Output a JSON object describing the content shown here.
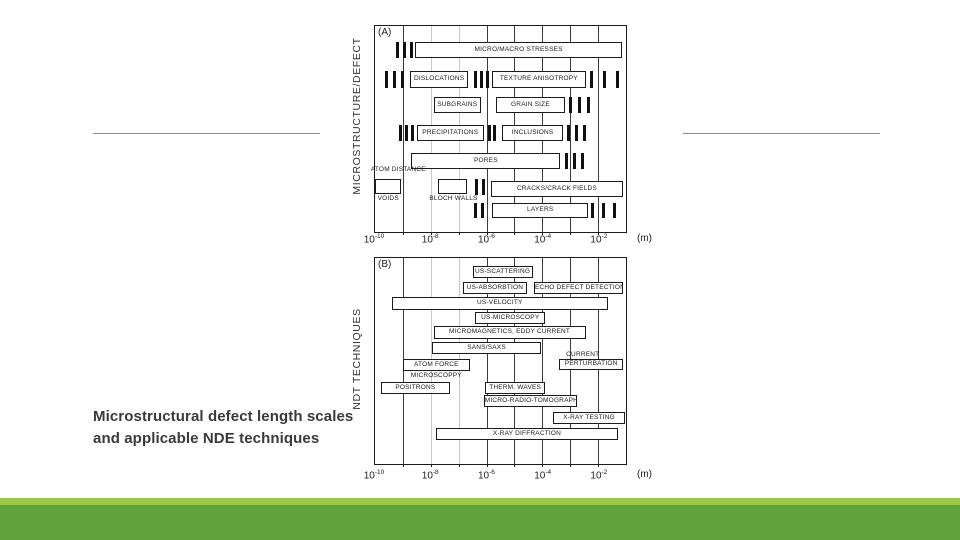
{
  "slide": {
    "caption_line1": "Microstructural defect length scales",
    "caption_line2": "and applicable NDE techniques",
    "caption_color": "#3a3a3a",
    "accent_light_green": "#9bc847",
    "accent_dark_green": "#61a33d",
    "divider_color": "#8a8a8a"
  },
  "chart_data": [
    {
      "type": "bar",
      "id": "A",
      "corner_label": "(A)",
      "axis_title": "MICROSTRUCTURE/DEFECT",
      "unit_label": "(m)",
      "x_scale": "log10 length in meters",
      "x_min": -10,
      "x_max": -1,
      "x_tick_exponents": [
        -10,
        -8,
        -6,
        -4,
        -2
      ],
      "gridline_exponents": [
        -9,
        -8,
        -7,
        -6,
        -5,
        -4,
        -3,
        -2
      ],
      "light_gridlines": [
        -8,
        -7
      ],
      "items": [
        {
          "type": "ticks",
          "from": -9.25,
          "to": -8.65,
          "top": 16,
          "h": 16
        },
        {
          "type": "box",
          "label": "MICRO/MACRO STRESSES",
          "from": -8.55,
          "to": -1.15,
          "top": 16,
          "h": 16
        },
        {
          "type": "ticks",
          "from": -9.65,
          "to": -8.95,
          "top": 45,
          "h": 17
        },
        {
          "type": "box",
          "label": "DISLOCATIONS",
          "from": -8.75,
          "to": -6.65,
          "top": 45,
          "h": 17
        },
        {
          "type": "ticks",
          "from": -6.45,
          "to": -5.9,
          "top": 45,
          "h": 17
        },
        {
          "type": "box",
          "label": "TEXTURE ANISOTROPY",
          "from": -5.8,
          "to": -2.45,
          "top": 45,
          "h": 17
        },
        {
          "type": "ticks",
          "from": -2.3,
          "to": -1.25,
          "top": 45,
          "h": 17
        },
        {
          "type": "box",
          "label": "SUBGRAINS",
          "from": -7.9,
          "to": -6.2,
          "top": 71,
          "h": 16
        },
        {
          "type": "box",
          "label": "GRAIN SIZE",
          "from": -5.65,
          "to": -3.2,
          "top": 71,
          "h": 16
        },
        {
          "type": "ticks",
          "from": -3.05,
          "to": -2.3,
          "top": 71,
          "h": 16
        },
        {
          "type": "ticks",
          "from": -9.15,
          "to": -8.6,
          "top": 99,
          "h": 16
        },
        {
          "type": "box",
          "label": "PRECIPITATIONS",
          "from": -8.5,
          "to": -6.1,
          "top": 99,
          "h": 16
        },
        {
          "type": "ticks",
          "from": -5.95,
          "to": -5.65,
          "top": 99,
          "h": 16,
          "n": 2
        },
        {
          "type": "box",
          "label": "INCLUSIONS",
          "from": -5.45,
          "to": -3.25,
          "top": 99,
          "h": 16
        },
        {
          "type": "ticks",
          "from": -3.1,
          "to": -2.45,
          "top": 99,
          "h": 16
        },
        {
          "type": "box",
          "label": "PORES",
          "from": -8.7,
          "to": -3.35,
          "top": 127,
          "h": 16
        },
        {
          "type": "ticks",
          "from": -3.2,
          "to": -2.5,
          "top": 127,
          "h": 16
        },
        {
          "type": "text",
          "label": "ATOM DISTANCE",
          "from": -10.15,
          "to": -7.0,
          "top": 140,
          "h": 11,
          "align": "left"
        },
        {
          "type": "box",
          "label": "",
          "from": -10,
          "to": -9.05,
          "top": 153,
          "h": 15
        },
        {
          "type": "text",
          "label": "VOIDS",
          "from": -10,
          "to": -9.05,
          "top": 169,
          "h": 10
        },
        {
          "type": "box",
          "label": "",
          "from": -7.75,
          "to": -6.7,
          "top": 153,
          "h": 15
        },
        {
          "type": "text",
          "label": "BLOCH WALLS",
          "from": -8.05,
          "to": -6.4,
          "top": 169,
          "h": 10
        },
        {
          "type": "ticks",
          "from": -6.4,
          "to": -6.05,
          "top": 153,
          "h": 16,
          "n": 2
        },
        {
          "type": "box",
          "label": "CRACKS/CRACK FIELDS",
          "from": -5.85,
          "to": -1.1,
          "top": 155,
          "h": 16
        },
        {
          "type": "ticks",
          "from": -6.45,
          "to": -6.1,
          "top": 177,
          "h": 15,
          "n": 2
        },
        {
          "type": "box",
          "label": "LAYERS",
          "from": -5.8,
          "to": -2.35,
          "top": 177,
          "h": 15
        },
        {
          "type": "ticks",
          "from": -2.25,
          "to": -1.35,
          "top": 177,
          "h": 15
        }
      ]
    },
    {
      "type": "bar",
      "id": "B",
      "corner_label": "(B)",
      "axis_title": "NDT TECHNIQUES",
      "unit_label": "(m)",
      "x_scale": "log10 length in meters",
      "x_min": -10,
      "x_max": -1,
      "x_tick_exponents": [
        -10,
        -8,
        -6,
        -4,
        -2
      ],
      "gridline_exponents": [
        -9,
        -8,
        -7,
        -6,
        -5,
        -4,
        -3,
        -2
      ],
      "light_gridlines": [
        -8,
        -7
      ],
      "items": [
        {
          "type": "box",
          "label": "US-SCATTERING",
          "from": -6.5,
          "to": -4.35,
          "top": 8,
          "h": 12
        },
        {
          "type": "box",
          "label": "US-ABSORBTION",
          "from": -6.85,
          "to": -4.55,
          "top": 24,
          "h": 12
        },
        {
          "type": "box",
          "label": "ECHO DEFECT DETECTION",
          "from": -4.3,
          "to": -1.1,
          "top": 24,
          "h": 12
        },
        {
          "type": "box",
          "label": "US-VELOCITY",
          "from": -9.4,
          "to": -1.65,
          "top": 39,
          "h": 13
        },
        {
          "type": "box",
          "label": "US-MICROSCOPY",
          "from": -6.4,
          "to": -3.9,
          "top": 54,
          "h": 12
        },
        {
          "type": "box",
          "label": "MICROMAGNETICS, EDDY CURRENT",
          "from": -7.9,
          "to": -2.45,
          "top": 68,
          "h": 13
        },
        {
          "type": "box",
          "label": "SANS/SAXS",
          "from": -7.95,
          "to": -4.05,
          "top": 84,
          "h": 12
        },
        {
          "type": "text",
          "label": "CURRENT",
          "from": -3.5,
          "to": -1.6,
          "top": 93,
          "h": 9
        },
        {
          "type": "box",
          "label": "PERTURBATION",
          "from": -3.4,
          "to": -1.1,
          "top": 101,
          "h": 11
        },
        {
          "type": "box",
          "label": "ATOM FORCE",
          "from": -9.0,
          "to": -6.6,
          "top": 101,
          "h": 12
        },
        {
          "type": "text",
          "label": "MICROSCOPPY",
          "from": -9.0,
          "to": -6.6,
          "top": 114,
          "h": 9
        },
        {
          "type": "box",
          "label": "POSITRONS",
          "from": -9.8,
          "to": -7.3,
          "top": 124,
          "h": 12
        },
        {
          "type": "box",
          "label": "THERM. WAVES",
          "from": -6.05,
          "to": -3.9,
          "top": 124,
          "h": 12
        },
        {
          "type": "box",
          "label": "MICRO-RADIO-TOMOGRAPHY",
          "from": -6.1,
          "to": -2.75,
          "top": 137,
          "h": 12
        },
        {
          "type": "box",
          "label": "X-RAY TESTING",
          "from": -3.6,
          "to": -1.05,
          "top": 154,
          "h": 12
        },
        {
          "type": "box",
          "label": "X-RAY DIFFRACTION",
          "from": -7.8,
          "to": -1.3,
          "top": 170,
          "h": 12
        }
      ]
    }
  ]
}
